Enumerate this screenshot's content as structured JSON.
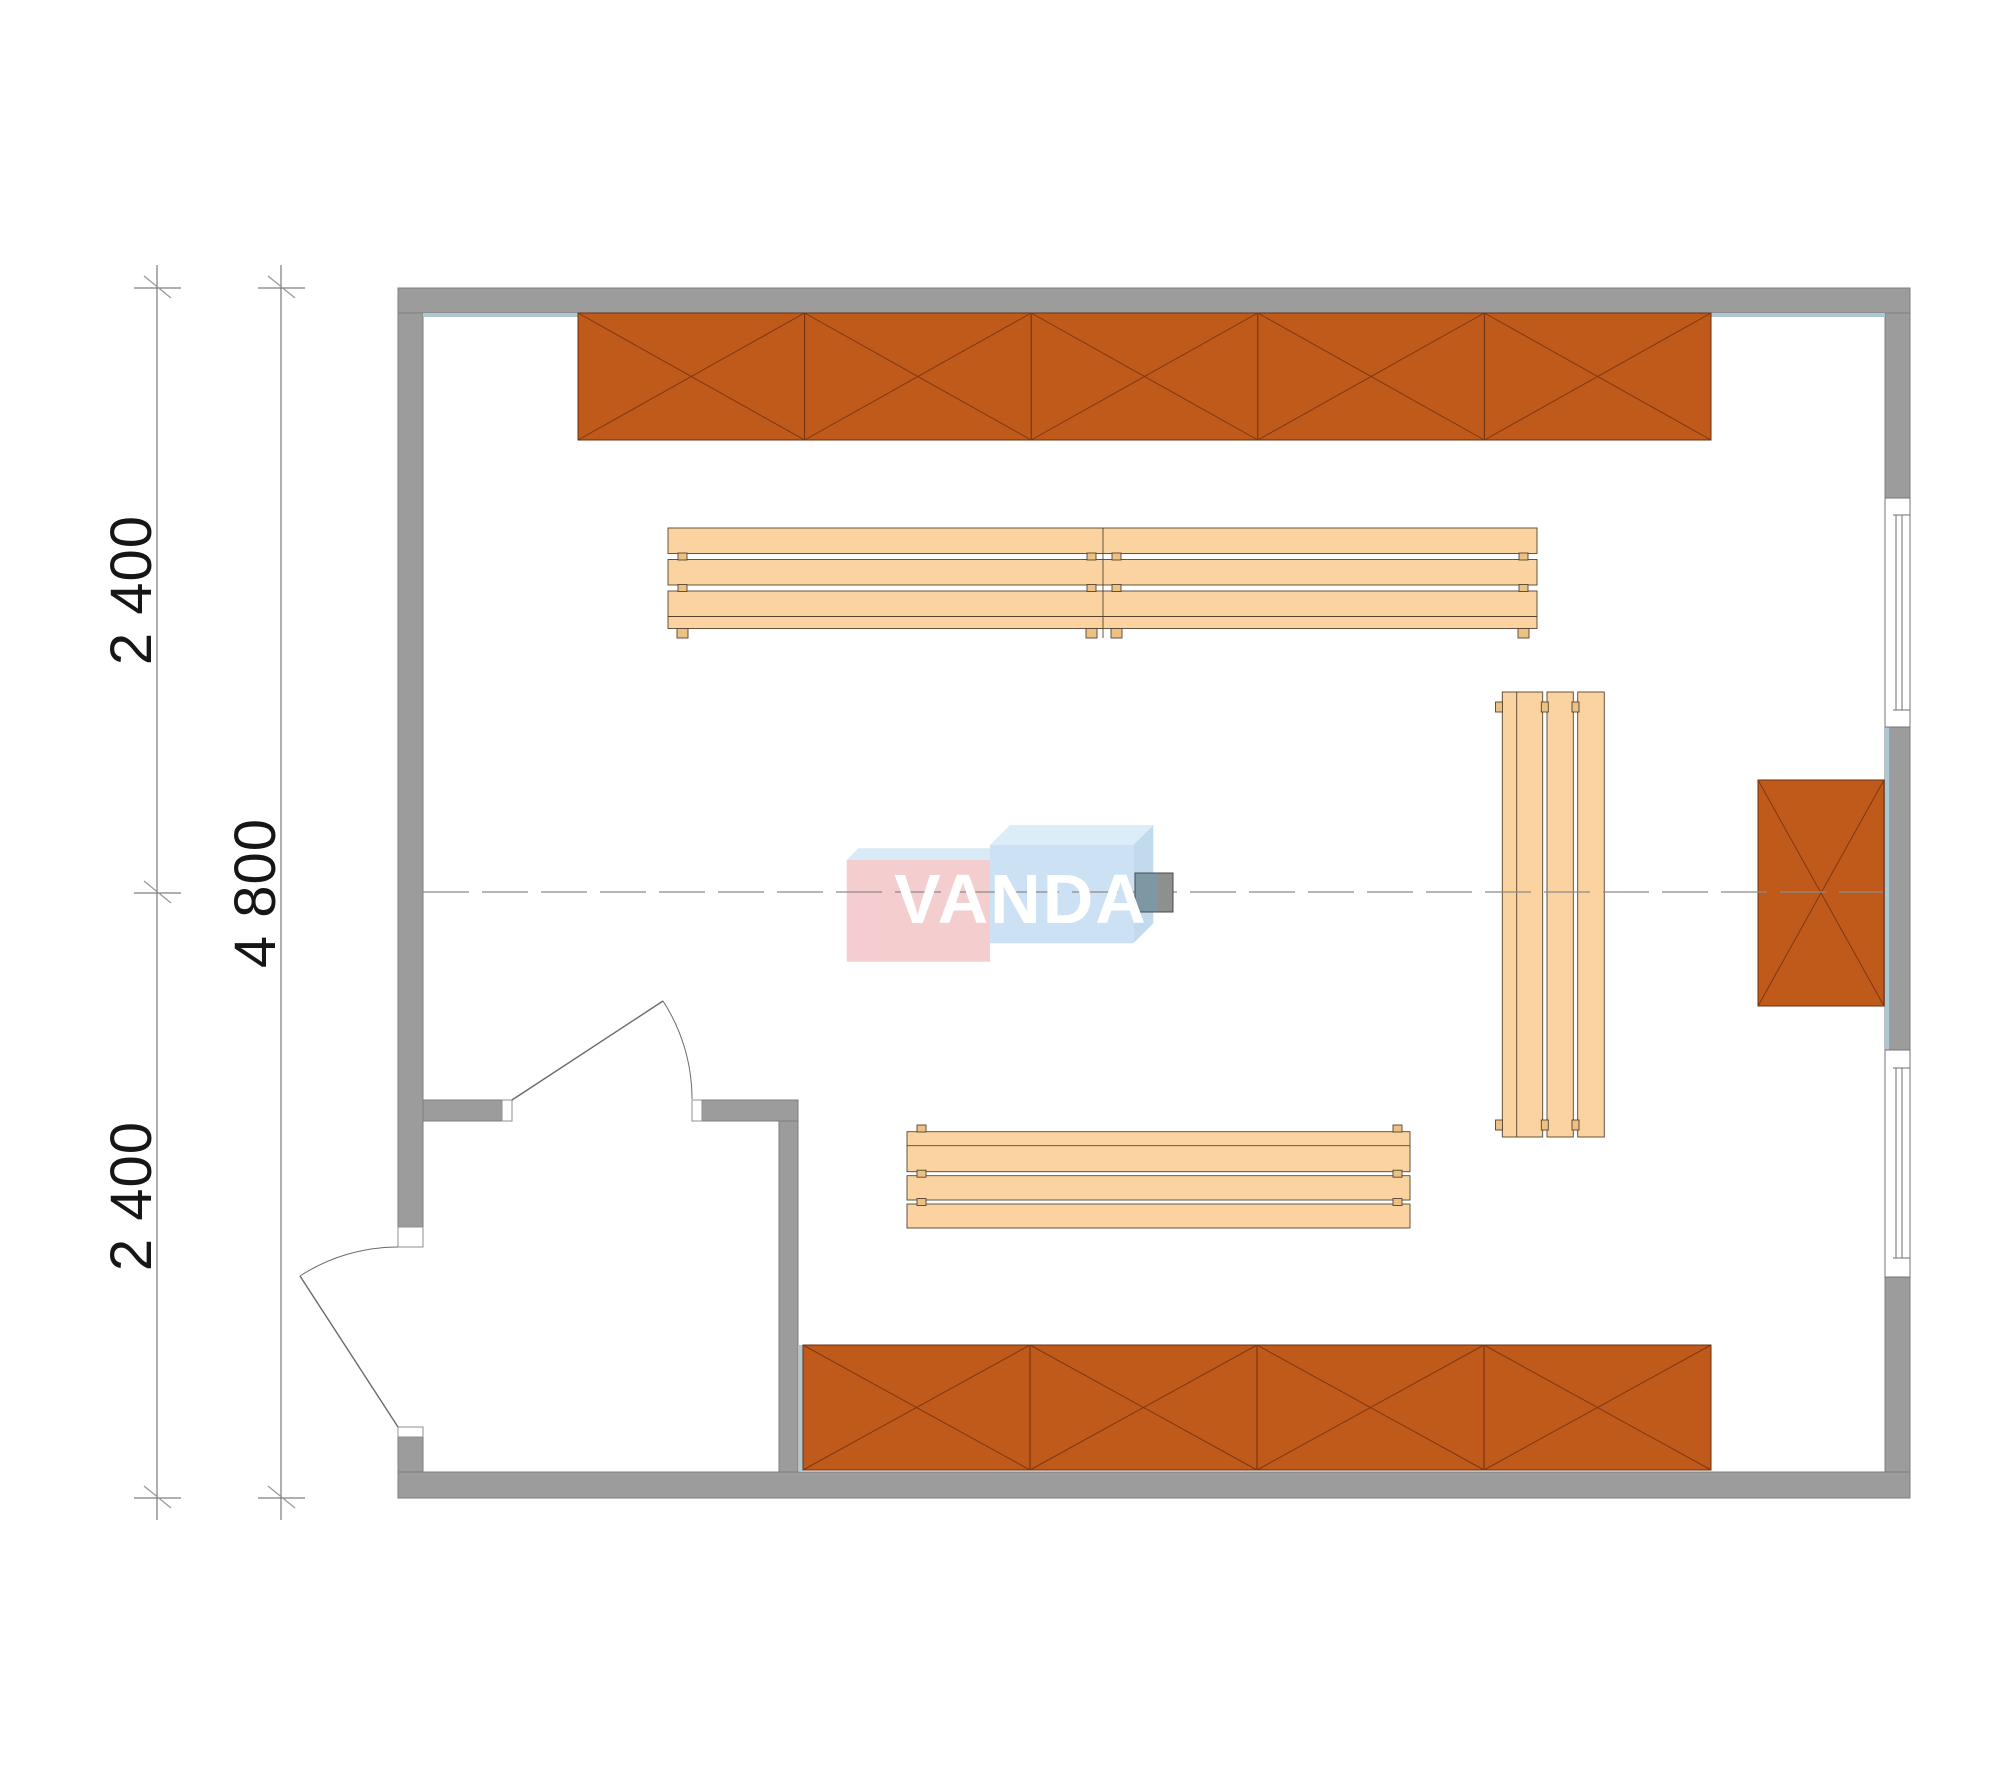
{
  "watermark": {
    "text": "VANDA"
  },
  "dimensions": {
    "left_segment_top": "2 400",
    "left_segment_bottom": "2 400",
    "left_total": "4 800"
  },
  "inventory": {
    "top_shelf_sections": 5,
    "bottom_shelf_sections": 4,
    "wall_shelf_sections": 1,
    "benches": 3,
    "windows": 2,
    "doors": 2,
    "heaters": 1
  },
  "colors": {
    "wall_gray": "#9C9C9C",
    "shelf_orange": "#C05A1B",
    "shelf_line": "#7D3713",
    "bench_wood": "#FBD3A0",
    "bench_tab": "#EDC084",
    "accent_blue": "#ABC8D3",
    "heater_teal": "#7D98A2",
    "heater_gray": "#8F8F8F",
    "logo_pink": "#F4C9CC",
    "logo_blue": "#C8DFF2",
    "logo_top": "#D9ECF9",
    "dimension_text": "#161616"
  }
}
